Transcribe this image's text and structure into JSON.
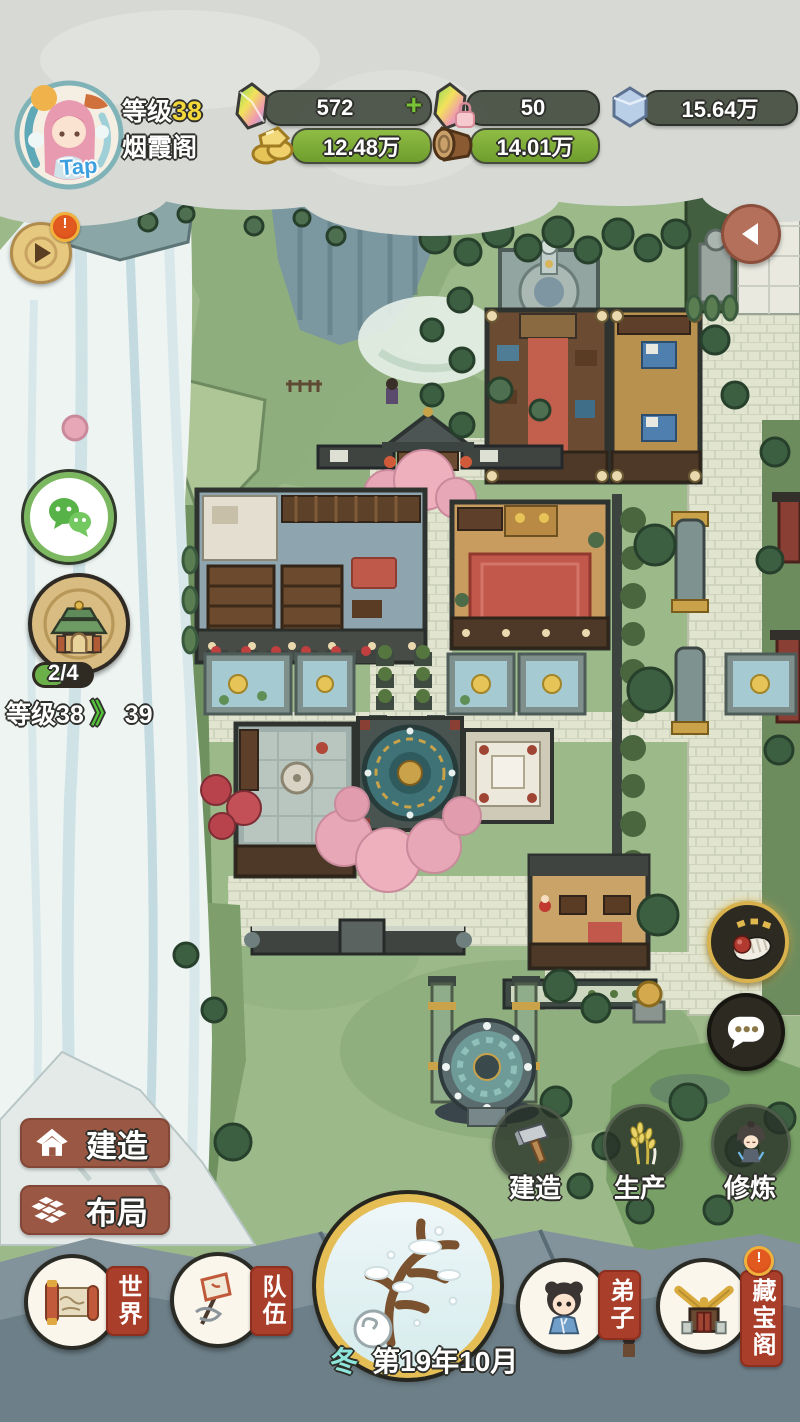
{
  "player": {
    "tap": "Tap",
    "level_label": "等级",
    "level_value": "38",
    "name": "烟霞阁"
  },
  "resources": {
    "gem": "572",
    "add": "+",
    "gem_locked": "50",
    "stone": "15.64万",
    "gold": "12.48万",
    "wood": "14.01万"
  },
  "left_panel": {
    "alert": "!",
    "sect_progress": "2/4",
    "level_label": "等级",
    "level_current": "38",
    "level_arrow": "》",
    "level_next": "39"
  },
  "build_menu": {
    "build": "建造",
    "layout": "布局"
  },
  "quick_actions": {
    "build": "建造",
    "produce": "生产",
    "cultivate": "修炼"
  },
  "bottom_nav": {
    "world": "世界",
    "team": "队伍",
    "disciple": "弟子",
    "treasure": "藏宝阁",
    "treasure_alert": "!"
  },
  "date": {
    "season": "冬",
    "text": "第19年10月"
  },
  "colors": {
    "resource_bar_green": "#7fae3e",
    "panel_brown": "#9a5743",
    "tag_red": "#a93e2a",
    "level_yellow": "#f4d83a",
    "season_teal": "#8ee6da",
    "plus_green": "#79c436"
  }
}
